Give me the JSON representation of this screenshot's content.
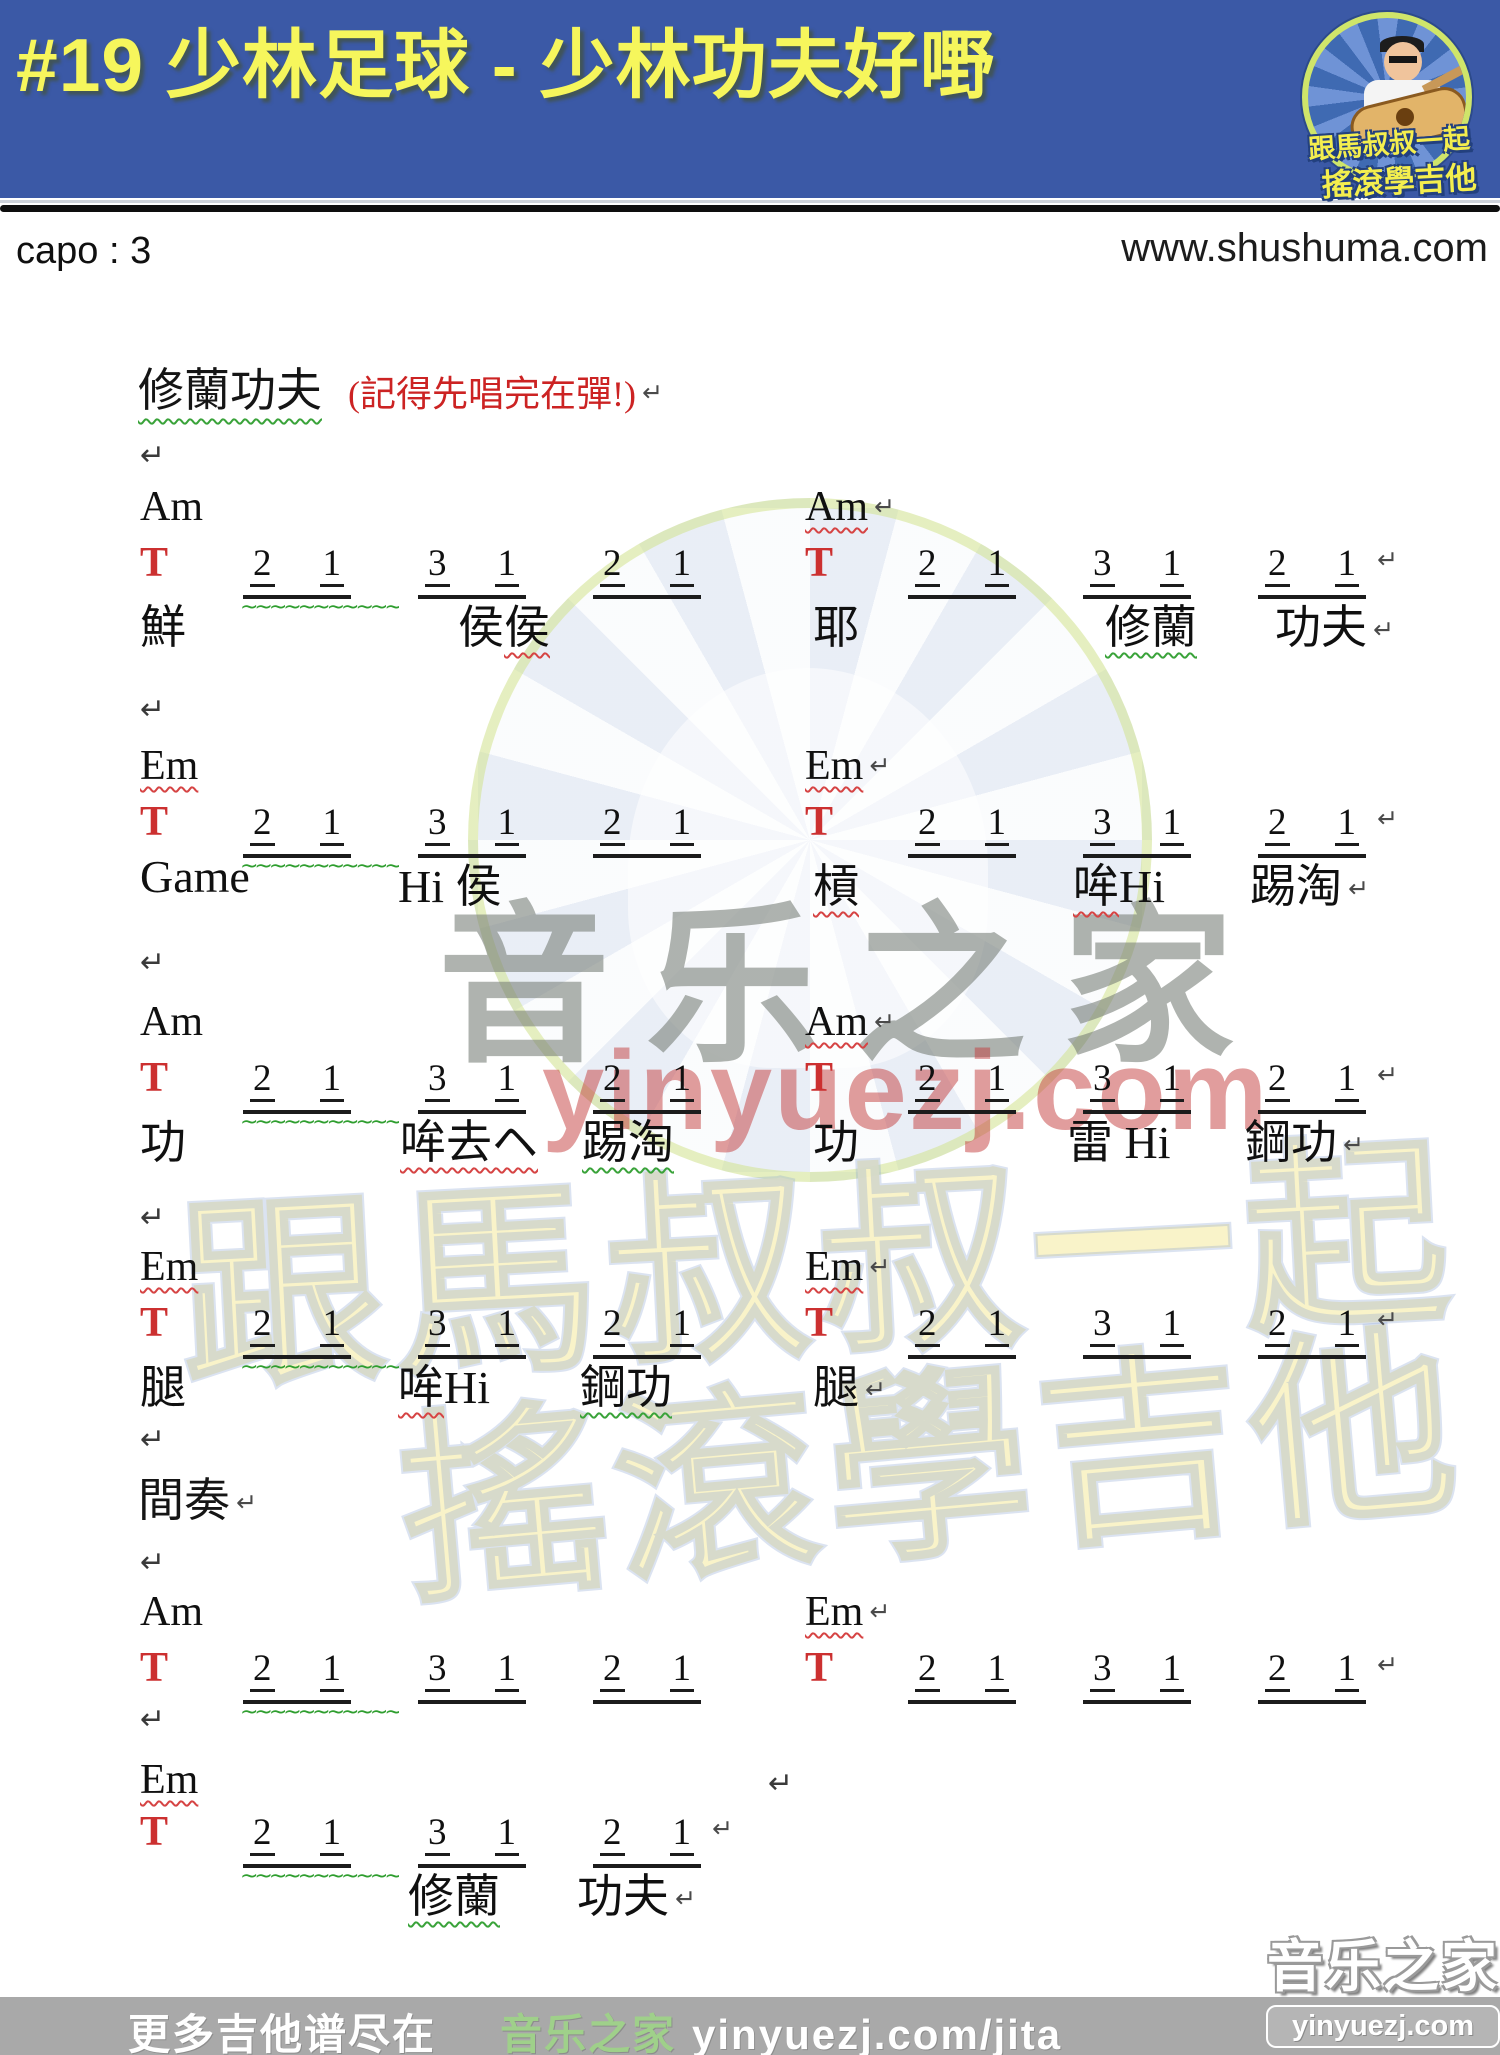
{
  "header": {
    "title": "#19 少林足球 - 少林功夫好嘢",
    "logo": {
      "line1": "跟馬叔叔一起",
      "line2": "搖滾學吉他"
    }
  },
  "meta": {
    "capo": "capo : 3",
    "site": "www.shushuma.com"
  },
  "watermarks": {
    "big_text": "音乐之家",
    "url_text": "yinyuezj.com",
    "badge_line1": "跟馬叔叔一起",
    "badge_line2": "搖滾學吉他"
  },
  "footer": {
    "left": "更多吉他谱尽在",
    "brand": "音乐之家",
    "url": "yinyuezj.com/jita",
    "corner_brand": "音乐之家",
    "corner_url": "yinyuezj.com"
  },
  "sheet": {
    "heading": {
      "text": "修蘭功夫",
      "note": "(記得先唱完在彈!)"
    },
    "interlude": "間奏",
    "tab_symbol": "T",
    "return_symbol": "↵",
    "returns": [
      {
        "x": 140,
        "y": 438
      },
      {
        "x": 140,
        "y": 692
      },
      {
        "x": 140,
        "y": 945
      },
      {
        "x": 140,
        "y": 1200
      },
      {
        "x": 140,
        "y": 1422
      },
      {
        "x": 140,
        "y": 1545
      },
      {
        "x": 140,
        "y": 1702
      },
      {
        "x": 768,
        "y": 1766
      }
    ],
    "sections": [
      {
        "y": 483,
        "halves": [
          {
            "x": 140,
            "chord": {
              "name": "Am",
              "wavy": null,
              "ret": false
            },
            "tab": {
              "groups": [
                [
                  "2",
                  "1"
                ],
                [
                  "3",
                  "1"
                ],
                [
                  "2",
                  "1"
                ]
              ],
              "g1_wavy": true,
              "ret": false
            },
            "lyrics": [
              {
                "x": 0,
                "parts": [
                  {
                    "t": "鮮",
                    "w": null
                  }
                ]
              },
              {
                "x": 318,
                "parts": [
                  {
                    "t": "侯",
                    "w": null
                  },
                  {
                    "t": "侯",
                    "w": "red"
                  }
                ]
              }
            ]
          },
          {
            "x": 805,
            "chord": {
              "name": "Am",
              "wavy": "red",
              "ret": true
            },
            "tab": {
              "groups": [
                [
                  "2",
                  "1"
                ],
                [
                  "3",
                  "1"
                ],
                [
                  "2",
                  "1"
                ]
              ],
              "g1_wavy": false,
              "ret": true
            },
            "lyrics": [
              {
                "x": 8,
                "parts": [
                  {
                    "t": "耶",
                    "w": null
                  }
                ]
              },
              {
                "x": 300,
                "parts": [
                  {
                    "t": "修蘭",
                    "w": "green"
                  }
                ]
              },
              {
                "x": 470,
                "parts": [
                  {
                    "t": "功夫",
                    "w": null
                  }
                ],
                "ret": true
              }
            ]
          }
        ]
      },
      {
        "y": 742,
        "halves": [
          {
            "x": 140,
            "chord": {
              "name": "Em",
              "wavy": "red",
              "ret": false
            },
            "tab": {
              "groups": [
                [
                  "2",
                  "1"
                ],
                [
                  "3",
                  "1"
                ],
                [
                  "2",
                  "1"
                ]
              ],
              "g1_wavy": true,
              "ret": false
            },
            "lyrics": [
              {
                "x": 0,
                "parts": [
                  {
                    "t": "Game",
                    "w": null
                  }
                ]
              },
              {
                "x": 258,
                "parts": [
                  {
                    "t": "Hi 侯",
                    "w": null
                  }
                ]
              }
            ]
          },
          {
            "x": 805,
            "chord": {
              "name": "Em",
              "wavy": "red",
              "ret": true
            },
            "tab": {
              "groups": [
                [
                  "2",
                  "1"
                ],
                [
                  "3",
                  "1"
                ],
                [
                  "2",
                  "1"
                ]
              ],
              "g1_wavy": false,
              "ret": true
            },
            "lyrics": [
              {
                "x": 8,
                "parts": [
                  {
                    "t": "槓",
                    "w": "red"
                  }
                ]
              },
              {
                "x": 268,
                "parts": [
                  {
                    "t": "哞",
                    "w": "red"
                  },
                  {
                    "t": "Hi",
                    "w": null
                  }
                ]
              },
              {
                "x": 445,
                "parts": [
                  {
                    "t": "踢淘",
                    "w": null
                  }
                ],
                "ret": true
              }
            ]
          }
        ]
      },
      {
        "y": 998,
        "halves": [
          {
            "x": 140,
            "chord": {
              "name": "Am",
              "wavy": null,
              "ret": false
            },
            "tab": {
              "groups": [
                [
                  "2",
                  "1"
                ],
                [
                  "3",
                  "1"
                ],
                [
                  "2",
                  "1"
                ]
              ],
              "g1_wavy": true,
              "ret": false
            },
            "lyrics": [
              {
                "x": 0,
                "parts": [
                  {
                    "t": "功",
                    "w": null
                  }
                ]
              },
              {
                "x": 260,
                "parts": [
                  {
                    "t": "哞去ヘ",
                    "w": "red"
                  }
                ]
              },
              {
                "x": 442,
                "parts": [
                  {
                    "t": "踢淘",
                    "w": "green"
                  }
                ]
              }
            ]
          },
          {
            "x": 805,
            "chord": {
              "name": "Am",
              "wavy": "red",
              "ret": true
            },
            "tab": {
              "groups": [
                [
                  "2",
                  "1"
                ],
                [
                  "3",
                  "1"
                ],
                [
                  "2",
                  "1"
                ]
              ],
              "g1_wavy": false,
              "ret": true
            },
            "lyrics": [
              {
                "x": 8,
                "parts": [
                  {
                    "t": "功",
                    "w": null
                  }
                ]
              },
              {
                "x": 262,
                "parts": [
                  {
                    "t": "雷 Hi",
                    "w": null
                  }
                ]
              },
              {
                "x": 440,
                "parts": [
                  {
                    "t": "鋼功",
                    "w": null
                  }
                ],
                "ret": true
              }
            ]
          }
        ]
      },
      {
        "y": 1243,
        "halves": [
          {
            "x": 140,
            "chord": {
              "name": "Em",
              "wavy": "red",
              "ret": false
            },
            "tab": {
              "groups": [
                [
                  "2",
                  "1"
                ],
                [
                  "3",
                  "1"
                ],
                [
                  "2",
                  "1"
                ]
              ],
              "g1_wavy": true,
              "ret": false
            },
            "lyrics": [
              {
                "x": 0,
                "parts": [
                  {
                    "t": "腿",
                    "w": null
                  }
                ]
              },
              {
                "x": 258,
                "parts": [
                  {
                    "t": "哞",
                    "w": "red"
                  },
                  {
                    "t": "Hi",
                    "w": null
                  }
                ]
              },
              {
                "x": 440,
                "parts": [
                  {
                    "t": "鋼功",
                    "w": "green"
                  }
                ]
              }
            ]
          },
          {
            "x": 805,
            "chord": {
              "name": "Em",
              "wavy": "red",
              "ret": true
            },
            "tab": {
              "groups": [
                [
                  "2",
                  "1"
                ],
                [
                  "3",
                  "1"
                ],
                [
                  "2",
                  "1"
                ]
              ],
              "g1_wavy": false,
              "ret": true
            },
            "lyrics": [
              {
                "x": 8,
                "parts": [
                  {
                    "t": "腿",
                    "w": null
                  }
                ],
                "ret": true
              }
            ]
          }
        ]
      },
      {
        "y": 1588,
        "halves": [
          {
            "x": 140,
            "chord": {
              "name": "Am",
              "wavy": null,
              "ret": false
            },
            "tab": {
              "groups": [
                [
                  "2",
                  "1"
                ],
                [
                  "3",
                  "1"
                ],
                [
                  "2",
                  "1"
                ]
              ],
              "g1_wavy": true,
              "ret": false
            },
            "lyrics": []
          },
          {
            "x": 805,
            "chord": {
              "name": "Em",
              "wavy": "red",
              "ret": true
            },
            "tab": {
              "groups": [
                [
                  "2",
                  "1"
                ],
                [
                  "3",
                  "1"
                ],
                [
                  "2",
                  "1"
                ]
              ],
              "g1_wavy": false,
              "ret": true
            },
            "lyrics": []
          }
        ]
      },
      {
        "y": 1756,
        "tab_dy": 52,
        "lyr_dy": 104,
        "halves": [
          {
            "x": 140,
            "chord": {
              "name": "Em",
              "wavy": "red",
              "ret": false
            },
            "tab": {
              "groups": [
                [
                  "2",
                  "1"
                ],
                [
                  "3",
                  "1"
                ],
                [
                  "2",
                  "1"
                ]
              ],
              "g1_wavy": true,
              "ret": true
            },
            "lyrics": [
              {
                "x": 268,
                "parts": [
                  {
                    "t": "修蘭",
                    "w": "green"
                  }
                ]
              },
              {
                "x": 437,
                "parts": [
                  {
                    "t": "功夫",
                    "w": null
                  }
                ],
                "ret": true
              }
            ]
          }
        ]
      }
    ]
  }
}
